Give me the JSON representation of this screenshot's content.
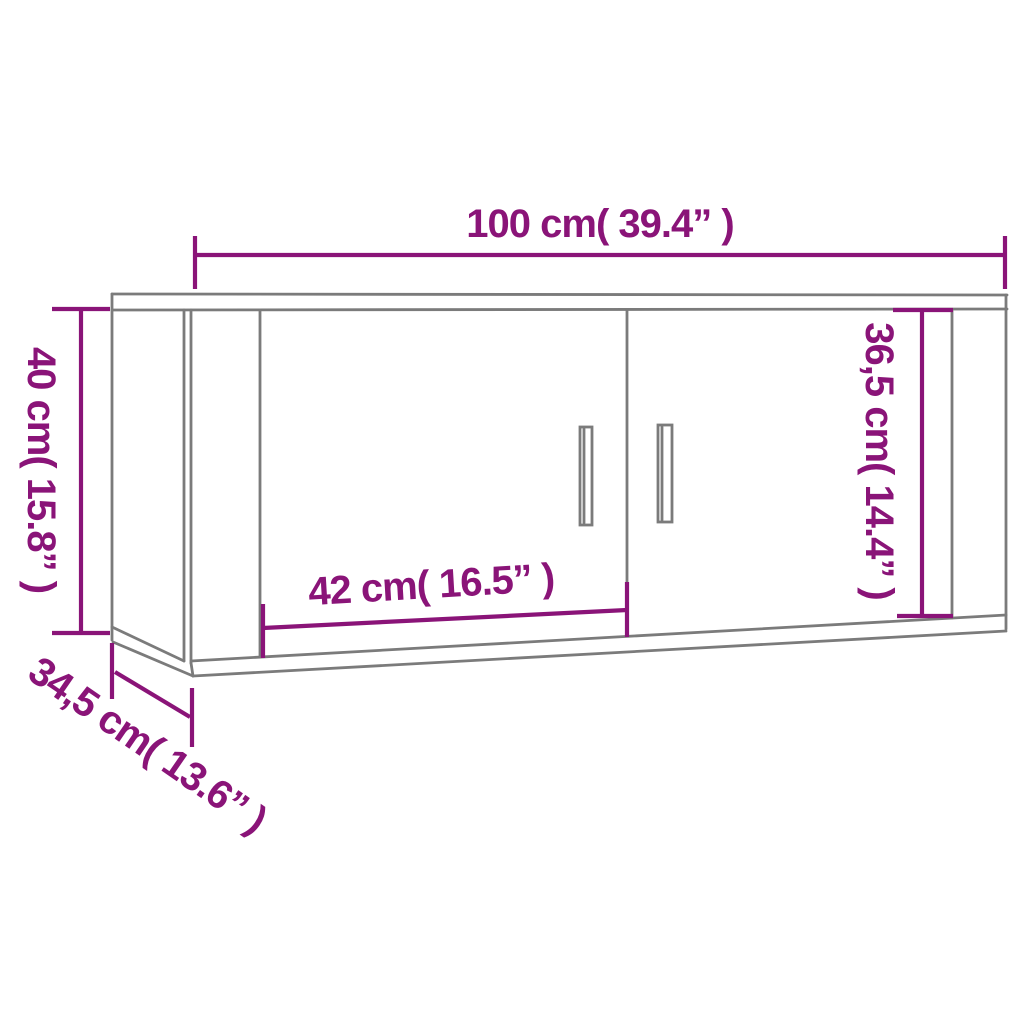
{
  "diagram": {
    "dimension_labels": {
      "overall_width": "100 cm( 39.4” )",
      "overall_height": "40 cm( 15.8” )",
      "door_height": "36,5 cm( 14.4” )",
      "door_width": "42 cm( 16.5” )",
      "depth": "34,5 cm( 13.6” )"
    },
    "colors": {
      "dimension": "#8A1478",
      "cabinet_line": "#7B7B7B",
      "background": "#FFFFFF"
    }
  }
}
